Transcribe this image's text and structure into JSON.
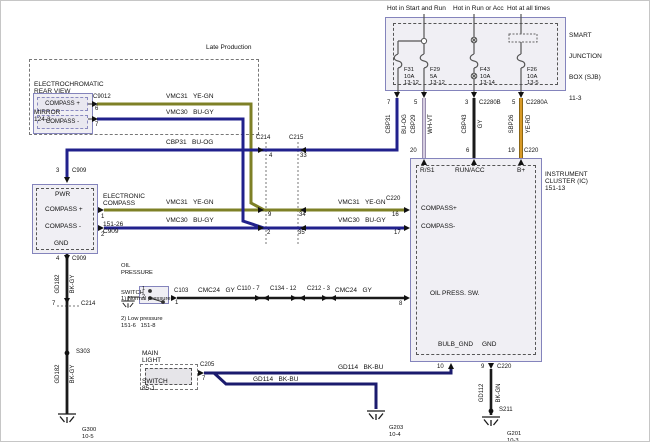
{
  "diagram": {
    "late_production": "Late Production",
    "mirror": {
      "name": [
        "ELECTROCHROMATIC",
        "REAR VIEW",
        "MIRROR",
        "124-3"
      ],
      "ports": [
        "COMPASS +",
        "COMPASS -"
      ],
      "connector": "C9012",
      "pin_plus": "6",
      "pin_minus": "7"
    },
    "compass": {
      "name": [
        "ELECTRONIC",
        "COMPASS",
        "151-26",
        "C909"
      ],
      "ports": [
        "PWR",
        "COMPASS +",
        "COMPASS -",
        "GND"
      ],
      "pin_top": "3",
      "conn_top": "C909",
      "pin_plus": "1",
      "pin_minus": "2",
      "pin_bottom": "4",
      "conn_bottom": "C909"
    },
    "sjb": {
      "name": [
        "SMART",
        "JUNCTION",
        "BOX (SJB)",
        "11-3"
      ],
      "feeds": [
        "Hot in Start and Run",
        "Hot in Run or Acc",
        "Hot at all times"
      ],
      "fuses": [
        [
          "F31",
          "10A",
          "13-12"
        ],
        [
          "F29",
          "5A",
          "13-12"
        ],
        [
          "F43",
          "10A",
          "13-14"
        ],
        [
          "F26",
          "10A",
          "13-5"
        ]
      ],
      "pins": [
        "7",
        "5",
        "3",
        "5"
      ],
      "connectors": [
        "C2280B",
        "C2280A"
      ]
    },
    "ic": {
      "name": [
        "INSTRUMENT",
        "CLUSTER (IC)",
        "151-13"
      ],
      "conn": "C220",
      "top_ports": [
        "R/S1",
        "RUN/ACC",
        "B+"
      ],
      "top_pins": [
        "20",
        "6",
        "19"
      ],
      "left_ports": [
        "COMPASS+",
        "COMPASS-",
        "OIL PRESS. SW."
      ],
      "left_pins": [
        "16",
        "17",
        "8"
      ],
      "bottom_ports": [
        "BULB_GND",
        "GND"
      ],
      "bottom_pins": [
        "10",
        "9"
      ]
    },
    "oil_switch": {
      "name": [
        "OIL",
        "PRESSURE",
        "SWITCH",
        "1) Normal pressure",
        "2) Low pressure",
        "151-6   151-8"
      ],
      "connector": "C103",
      "pin": "1",
      "contacts": [
        "1",
        "2"
      ]
    },
    "light_switch": {
      "name": [
        "MAIN",
        "LIGHT",
        "SWITCH",
        "85-1"
      ],
      "connector": "C205",
      "pin": "7"
    },
    "inline": {
      "c214": "C214",
      "c215": "C215",
      "c214_pins": [
        "4",
        "9",
        "2"
      ],
      "c215_pins": [
        "33",
        "34",
        "35"
      ],
      "c214_gnd_label": "C214",
      "c214_gnd_pin": "7",
      "oil_connectors": [
        "C110 - 7",
        "C134 - 12",
        "C212 - 3"
      ]
    },
    "wires": {
      "vmc31": "VMC31   YE-GN",
      "vmc30": "VMC30   BU-GY",
      "cbp31_h": "CBP31   BU-OG",
      "cbp31_v": [
        "CBP31",
        "BU-OG"
      ],
      "cbp29_v": [
        "CBP29",
        "WH-VT"
      ],
      "cbp43_v": [
        "CBP43",
        "GY"
      ],
      "sbp26_v": [
        "SBP26",
        "YE-RD"
      ],
      "gd182": [
        "GD182",
        "BK-GY"
      ],
      "gd112": [
        "GD112",
        "BK-GN"
      ],
      "cmc24": "CMC24   GY",
      "gd114": "GD114   BK-BU"
    },
    "grounds": {
      "g300": [
        "G300",
        "10-5"
      ],
      "g203": [
        "G203",
        "10-4"
      ],
      "g201": [
        "G201",
        "10-3"
      ]
    },
    "splices": {
      "s303": "S303",
      "s211": "S211"
    },
    "colors": {
      "ye_gn": "#7e8026",
      "bu": "#21218c",
      "bk_bu": "#1b1b6e",
      "wh_vt": "#d5cce0",
      "wh_vt_edge": "#9186a8",
      "ye_rd": "#d89a28",
      "ye_rd_edge": "#7a5a10",
      "bk": "#1a1a1a",
      "internal": "#555555",
      "box_border": "#8484bc"
    }
  }
}
